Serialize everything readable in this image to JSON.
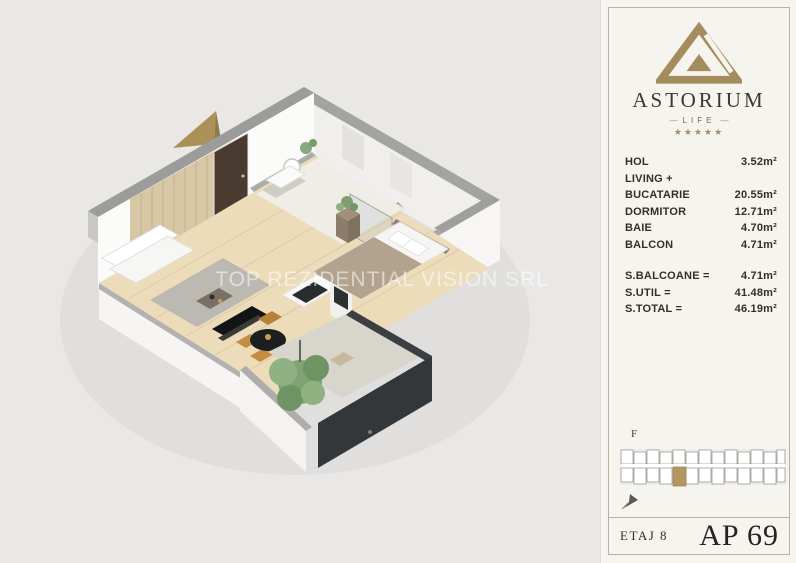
{
  "watermark": "TOP REZIDENTIAL VISION SRL",
  "panel": {
    "brand": {
      "name": "ASTORIUM",
      "tagline": "LIFE",
      "dash": "—",
      "stars": "★★★★★"
    },
    "rooms": [
      {
        "label": "HOL",
        "value": "3.52m²"
      },
      {
        "label": "LIVING +",
        "value": ""
      },
      {
        "label": "BUCATARIE",
        "value": "20.55m²"
      },
      {
        "label": "DORMITOR",
        "value": "12.71m²"
      },
      {
        "label": "BAIE",
        "value": "4.70m²"
      },
      {
        "label": "BALCON",
        "value": "4.71m²"
      }
    ],
    "totals": [
      {
        "label": "S.BALCOANE =",
        "value": "4.71m²"
      },
      {
        "label": "S.UTIL =",
        "value": "41.48m²"
      },
      {
        "label": "S.TOTAL =",
        "value": "46.19m²"
      }
    ],
    "locator": {
      "floor_letter": "F"
    },
    "footer": {
      "floor": "ETAJ 8",
      "apartment": "AP 69"
    }
  },
  "colors": {
    "gold": "#a58c5c",
    "panel_bg": "#f6f4ef",
    "panel_border": "#b9b0a1",
    "text": "#32302a",
    "canvas_bg": "#e9e8e6",
    "wall_gray": "#9d9d9b",
    "wood_floor": "#ecdcb9",
    "balcony_dark": "#34373a",
    "highlight_unit": "#b2985f"
  }
}
